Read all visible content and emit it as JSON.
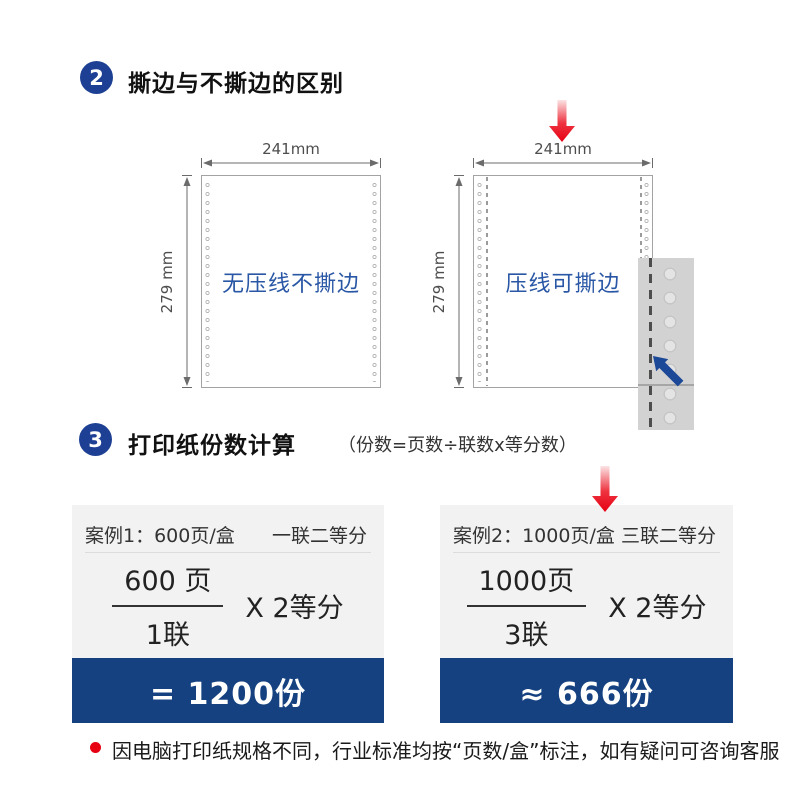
{
  "section2": {
    "badge": "2",
    "title": "撕边与不撕边的区别",
    "papers": {
      "left": {
        "width_label": "241mm",
        "height_label": "279 mm",
        "label": "无压线不撕边"
      },
      "right": {
        "width_label": "241mm",
        "height_label": "279 mm",
        "label": "压线可撕边"
      }
    }
  },
  "section3": {
    "badge": "3",
    "title": "打印纸份数计算",
    "formula_note": "（份数=页数÷联数x等分数）",
    "cases": [
      {
        "title": "案例1：600页/盒",
        "spec": "一联二等分",
        "numerator": "600 页",
        "denominator": "1联",
        "multiplier": "X 2等分",
        "result": "= 1200份"
      },
      {
        "title": "案例2：1000页/盒",
        "spec": "三联二等分",
        "numerator": "1000页",
        "denominator": "3联",
        "multiplier": "X 2等分",
        "result": "≈ 666份"
      }
    ]
  },
  "footnote": "因电脑打印纸规格不同，行业标准均按“页数/盒”标注，如有疑问可咨询客服",
  "colors": {
    "navy": "#154180",
    "badge_navy": "#1e4094",
    "paper_text_blue": "#2a57a5",
    "red": "#e60012"
  }
}
